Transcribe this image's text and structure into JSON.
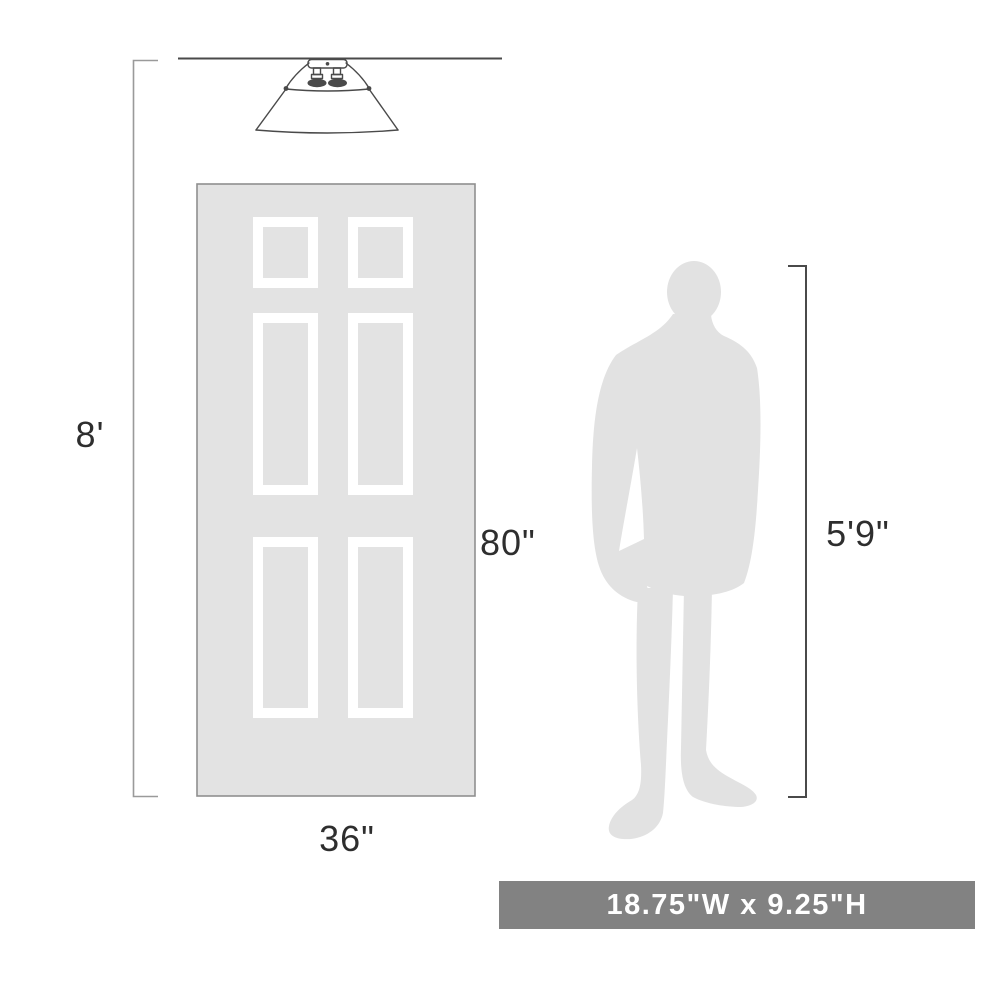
{
  "diagram": {
    "ceiling_height_label": "8'",
    "door_height_label": "80\"",
    "door_width_label": "36\"",
    "person_height_label": "5'9\"",
    "banner_text": "18.75\"W x 9.25\"H"
  },
  "icons": {
    "light_fixture": "flush-mount-cone-shade-light",
    "door": "six-panel-door",
    "person": "standing-person-silhouette"
  },
  "colors": {
    "silhouette": "#e2e2e2",
    "door-fill": "#e3e3e3",
    "panel-frame": "#ffffff",
    "ink": "#4a4a4a",
    "bracket-light": "#9a9a9a",
    "door-border": "#8f8f8f",
    "text": "#2e2e2e",
    "banner-bg": "#828282",
    "banner-text": "#ffffff"
  }
}
